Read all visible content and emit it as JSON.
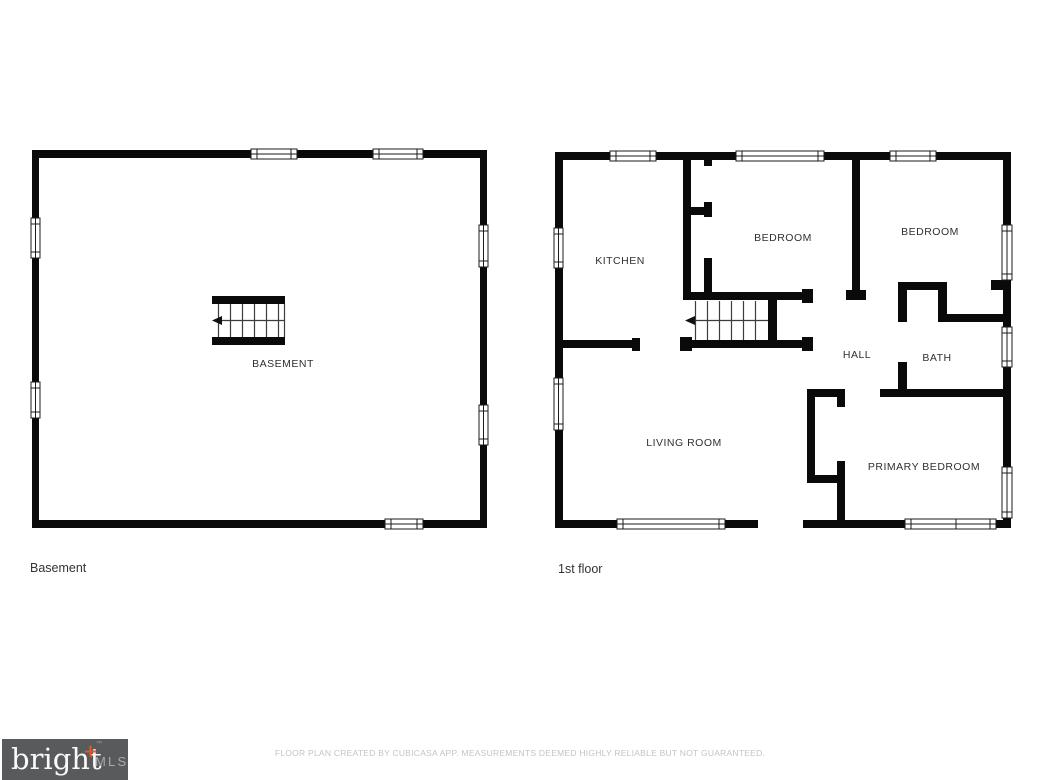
{
  "floors": [
    {
      "caption": "Basement",
      "rooms": [
        {
          "label": "BASEMENT"
        }
      ]
    },
    {
      "caption": "1st floor",
      "rooms": [
        {
          "label": "KITCHEN"
        },
        {
          "label": "BEDROOM"
        },
        {
          "label": "BEDROOM"
        },
        {
          "label": "HALL"
        },
        {
          "label": "BATH"
        },
        {
          "label": "LIVING ROOM"
        },
        {
          "label": "PRIMARY BEDROOM"
        }
      ]
    }
  ],
  "footer": {
    "logo": {
      "brand": "bright",
      "plus": "+",
      "trademark": "™",
      "suffix": "MLS"
    },
    "disclaimer": "FLOOR PLAN CREATED BY CUBICASA APP. MEASUREMENTS DEEMED HIGHLY RELIABLE BUT NOT GUARANTEED."
  },
  "colors": {
    "wall": "#0a0a0a",
    "room_label": "#303030",
    "caption": "#333333",
    "logo_bg": "#595a5c",
    "logo_text": "#fafafa",
    "logo_plus": "#e0572c",
    "logo_mls": "#a8a9ab",
    "disclaimer": "#c4c4c4"
  }
}
